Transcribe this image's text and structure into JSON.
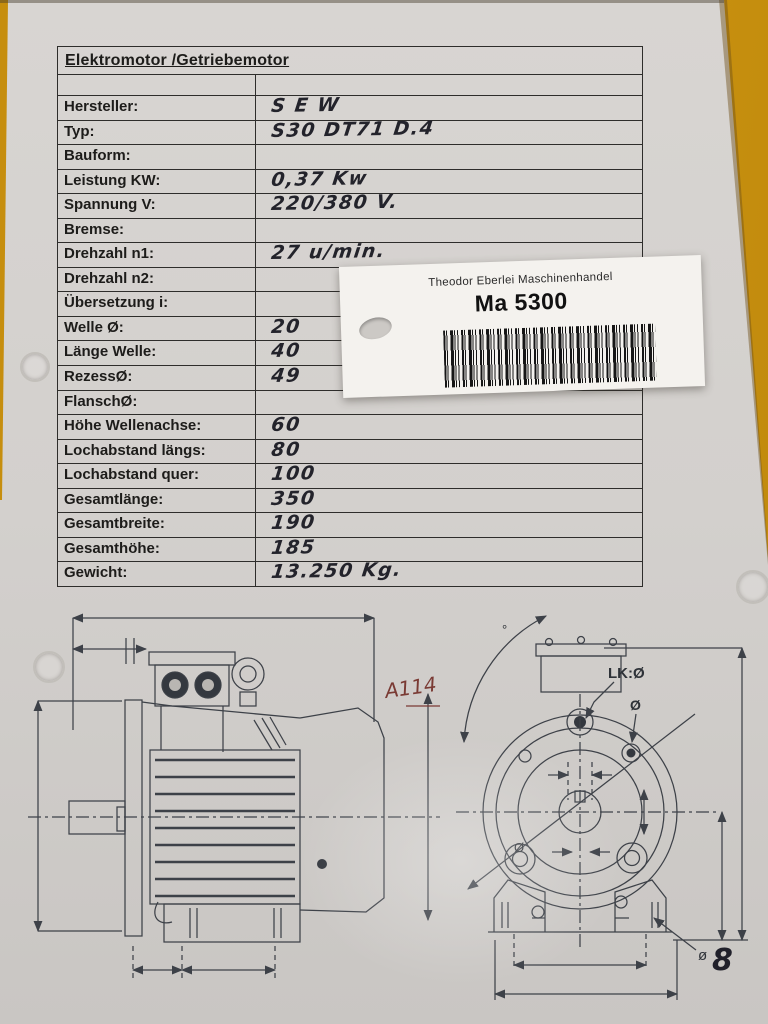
{
  "form": {
    "title": "Elektromotor /Getriebemotor",
    "rows": [
      {
        "label": "Hersteller:",
        "value": "S E W"
      },
      {
        "label": "Typ:",
        "value": "S30 DT71 D.4"
      },
      {
        "label": "Bauform:",
        "value": ""
      },
      {
        "label": "Leistung KW:",
        "value": "0,37 Kw"
      },
      {
        "label": "Spannung V:",
        "value": "220/380 V."
      },
      {
        "label": "Bremse:",
        "value": ""
      },
      {
        "label": "Drehzahl n1:",
        "value": "27 u/min."
      },
      {
        "label": "Drehzahl n2:",
        "value": ""
      },
      {
        "label": "Übersetzung i:",
        "value": ""
      },
      {
        "label": "Welle Ø:",
        "value": "20"
      },
      {
        "label": "Länge Welle:",
        "value": "40"
      },
      {
        "label": "RezessØ:",
        "value": "49"
      },
      {
        "label": "FlanschØ:",
        "value": ""
      },
      {
        "label": "Höhe Wellenachse:",
        "value": "60"
      },
      {
        "label": "Lochabstand längs:",
        "value": "80"
      },
      {
        "label": "Lochabstand quer:",
        "value": "100"
      },
      {
        "label": "Gesamtlänge:",
        "value": "350"
      },
      {
        "label": "Gesamtbreite:",
        "value": "190"
      },
      {
        "label": "Gesamthöhe:",
        "value": "185"
      },
      {
        "label": "Gewicht:",
        "value": "13.250 Kg."
      }
    ]
  },
  "sticker": {
    "company": "Theodor Eberlei Maschinenhandel",
    "code": "Ma 5300"
  },
  "drawings": {
    "side_view": {
      "red_annotation": "A114"
    },
    "front_view": {
      "degree_symbol": "°",
      "bolt_circle_label": "LK:Ø",
      "bolt_hole_label": "Ø",
      "flange_diameter_label": "Ø",
      "foot_hole_label": "ø",
      "foot_hole_value": "8"
    }
  },
  "colors": {
    "paper": "#d3d0cd",
    "table_surface_yellow": "#cd9311",
    "form_line": "#2e2d2b",
    "printed_text": "#1d1c1a",
    "handwriting_ink": "#23232b",
    "red_ink": "#7a3a34",
    "drawing_line": "#3d4148",
    "sticker_background": "#f4f2ee",
    "barcode": "#161616"
  }
}
